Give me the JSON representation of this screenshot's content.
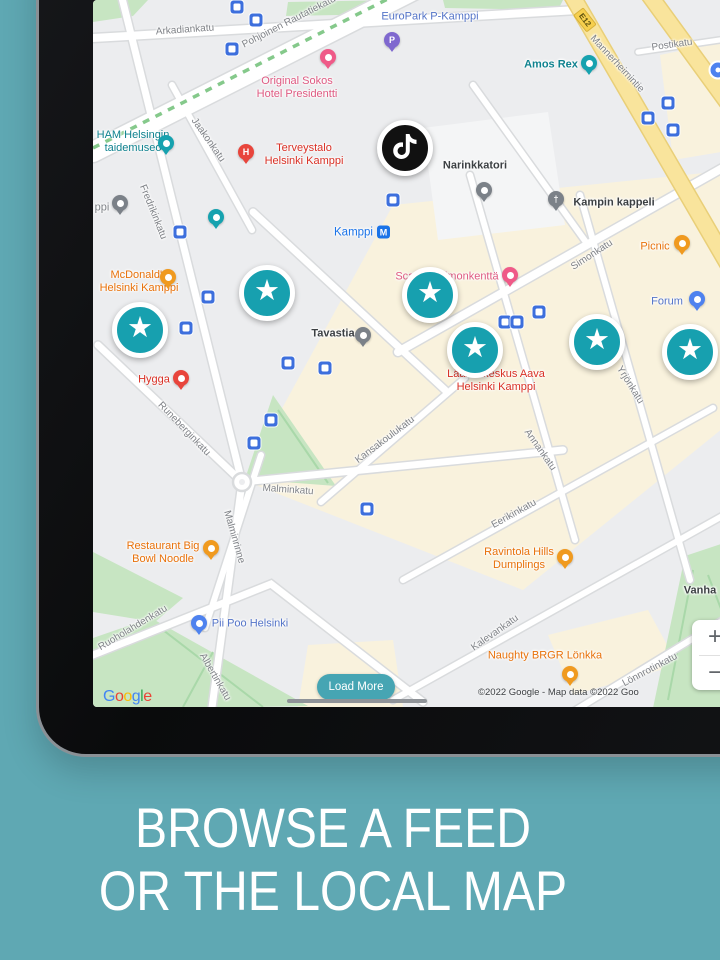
{
  "scene": {
    "background": "#5fa8b3"
  },
  "caption": {
    "line1": "BROWSE A FEED",
    "line2": "OR THE LOCAL MAP"
  },
  "colors": {
    "background_teal": "#5fa8b3",
    "star_teal": "#17a0af",
    "button_teal": "#46a5b3",
    "metro_blue": "#1a73e8",
    "road_yellow": "#f9e49c",
    "park_green": "#c7e5c2",
    "block_beige": "#f9f2dd",
    "hotel_pink": "#df5a82",
    "medical_red": "#d93025",
    "food_orange": "#e8710a",
    "poi_blue": "#5474c8",
    "attraction_teal": "#0f828f",
    "tiktok_black": "#111111"
  },
  "map": {
    "google_logo_letters": [
      "G",
      "o",
      "o",
      "g",
      "l",
      "e"
    ],
    "attribution": "©2022 Google - Map data ©2022 Goo",
    "load_more": "Load More",
    "zoom_in": "+",
    "zoom_out": "−",
    "star_glyph": "★",
    "metro": {
      "name": "Kamppi",
      "symbol": "M",
      "x": 269,
      "y": 232
    },
    "route_badge": {
      "text": "E12",
      "x": 492,
      "y": 20,
      "r": 52
    },
    "poi_dot": {
      "x": 625,
      "y": 70
    },
    "tiktok": {
      "x": 312,
      "y": 148
    },
    "street_labels": [
      {
        "t": "Arkadiankatu",
        "x": 92,
        "y": 30,
        "r": -4
      },
      {
        "t": "Pohjoinen Rautatiekatu",
        "x": 196,
        "y": 22,
        "r": -27
      },
      {
        "t": "Jaakonkatu",
        "x": 115,
        "y": 140,
        "r": 55
      },
      {
        "t": "Fredrikinkatu",
        "x": 60,
        "y": 212,
        "r": 68
      },
      {
        "t": "Mannerheimintie",
        "x": 524,
        "y": 64,
        "r": 47
      },
      {
        "t": "Postikatu",
        "x": 579,
        "y": 45,
        "r": -8
      },
      {
        "t": "Simonkatu",
        "x": 499,
        "y": 255,
        "r": -33
      },
      {
        "t": "Runeberginkatu",
        "x": 91,
        "y": 429,
        "r": 46
      },
      {
        "t": "Malminkatu",
        "x": 195,
        "y": 490,
        "r": 4
      },
      {
        "t": "Kansakoulukatu",
        "x": 292,
        "y": 440,
        "r": -37
      },
      {
        "t": "Annankatu",
        "x": 447,
        "y": 450,
        "r": 55
      },
      {
        "t": "Yrjönkatu",
        "x": 537,
        "y": 385,
        "r": 58
      },
      {
        "t": "Malminrinne",
        "x": 141,
        "y": 537,
        "r": 74
      },
      {
        "t": "Ruoholahdenkatu",
        "x": 40,
        "y": 628,
        "r": -31
      },
      {
        "t": "Albertinkatu",
        "x": 122,
        "y": 677,
        "r": 60
      },
      {
        "t": "Eerikinkatu",
        "x": 421,
        "y": 514,
        "r": -29
      },
      {
        "t": "Kalevankatu",
        "x": 402,
        "y": 633,
        "r": -35
      },
      {
        "t": "Lönnrotinkatu",
        "x": 557,
        "y": 670,
        "r": -28
      }
    ],
    "poi_labels": [
      {
        "lines": [
          "EuroPark P-Kamppi"
        ],
        "x": 337,
        "y": 17,
        "c": "blue"
      },
      {
        "lines": [
          "Original Sokos",
          "Hotel Presidentti"
        ],
        "x": 204,
        "y": 88,
        "c": "pink"
      },
      {
        "lines": [
          "Amos Rex"
        ],
        "x": 458,
        "y": 65,
        "c": "teal",
        "bold": true
      },
      {
        "lines": [
          "HAM Helsingin",
          "taidemuseo"
        ],
        "x": 40,
        "y": 142,
        "c": "teal"
      },
      {
        "lines": [
          "Terveystalo",
          "Helsinki Kamppi"
        ],
        "x": 211,
        "y": 155,
        "c": "red"
      },
      {
        "lines": [
          "Narinkkatori"
        ],
        "x": 382,
        "y": 166,
        "c": "dark"
      },
      {
        "lines": [
          "Kampin kappeli"
        ],
        "x": 521,
        "y": 203,
        "c": "dark"
      },
      {
        "lines": [
          "ppi"
        ],
        "x": 9,
        "y": 208,
        "c": "grey"
      },
      {
        "lines": [
          "Picnic"
        ],
        "x": 562,
        "y": 247,
        "c": "orange"
      },
      {
        "lines": [
          "Scandic Simonkenttä"
        ],
        "x": 354,
        "y": 277,
        "c": "pink"
      },
      {
        "lines": [
          "Forum"
        ],
        "x": 574,
        "y": 302,
        "c": "blue"
      },
      {
        "lines": [
          "McDonald's",
          "Helsinki Kamppi"
        ],
        "x": 46,
        "y": 282,
        "c": "orange"
      },
      {
        "lines": [
          "Tavastia"
        ],
        "x": 240,
        "y": 334,
        "c": "dark"
      },
      {
        "lines": [
          "Hygga"
        ],
        "x": 61,
        "y": 380,
        "c": "red"
      },
      {
        "lines": [
          "Lääkärikeskus Aava",
          "Helsinki Kamppi"
        ],
        "x": 403,
        "y": 381,
        "c": "red"
      },
      {
        "lines": [
          "Restaurant Big",
          "Bowl Noodle"
        ],
        "x": 70,
        "y": 553,
        "c": "orange"
      },
      {
        "lines": [
          "Ravintola Hills",
          "Dumplings"
        ],
        "x": 426,
        "y": 559,
        "c": "orange"
      },
      {
        "lines": [
          "Pii Poo Helsinki"
        ],
        "x": 157,
        "y": 624,
        "c": "blue"
      },
      {
        "lines": [
          "Naughty BRGR Lönkka"
        ],
        "x": 452,
        "y": 656,
        "c": "orange"
      },
      {
        "lines": [
          "Vanha"
        ],
        "x": 607,
        "y": 591,
        "c": "dark"
      }
    ],
    "markers": [
      {
        "type": "parking",
        "glyph": "P",
        "x": 299,
        "y": 40
      },
      {
        "type": "hotel",
        "x": 235,
        "y": 57
      },
      {
        "type": "attraction",
        "x": 496,
        "y": 63
      },
      {
        "type": "attraction",
        "x": 73,
        "y": 143
      },
      {
        "type": "hospital",
        "glyph": "H",
        "x": 153,
        "y": 152
      },
      {
        "type": "place",
        "x": 391,
        "y": 190
      },
      {
        "type": "place",
        "x": 27,
        "y": 203
      },
      {
        "type": "church",
        "glyph": "†",
        "x": 463,
        "y": 199
      },
      {
        "type": "attraction",
        "x": 123,
        "y": 217
      },
      {
        "type": "food",
        "x": 589,
        "y": 243
      },
      {
        "type": "shopping",
        "x": 604,
        "y": 299
      },
      {
        "type": "hotel",
        "x": 417,
        "y": 275
      },
      {
        "type": "food",
        "x": 75,
        "y": 277
      },
      {
        "type": "place",
        "x": 270,
        "y": 335
      },
      {
        "type": "medical",
        "x": 88,
        "y": 378
      },
      {
        "type": "food",
        "x": 118,
        "y": 548
      },
      {
        "type": "food",
        "x": 472,
        "y": 557
      },
      {
        "type": "shopping",
        "x": 106,
        "y": 623
      },
      {
        "type": "food",
        "x": 477,
        "y": 674
      }
    ],
    "stars": [
      {
        "x": 47,
        "y": 330
      },
      {
        "x": 174,
        "y": 293
      },
      {
        "x": 337,
        "y": 295
      },
      {
        "x": 382,
        "y": 350
      },
      {
        "x": 504,
        "y": 342
      },
      {
        "x": 597,
        "y": 352
      }
    ],
    "transit_icons": [
      {
        "x": 144,
        "y": 7
      },
      {
        "x": 163,
        "y": 20
      },
      {
        "x": 139,
        "y": 49
      },
      {
        "x": 300,
        "y": 200
      },
      {
        "x": 87,
        "y": 232
      },
      {
        "x": 115,
        "y": 297
      },
      {
        "x": 93,
        "y": 328
      },
      {
        "x": 446,
        "y": 312
      },
      {
        "x": 412,
        "y": 322
      },
      {
        "x": 424,
        "y": 322
      },
      {
        "x": 575,
        "y": 103
      },
      {
        "x": 555,
        "y": 118
      },
      {
        "x": 580,
        "y": 130
      },
      {
        "x": 195,
        "y": 363
      },
      {
        "x": 232,
        "y": 368
      },
      {
        "x": 178,
        "y": 420
      },
      {
        "x": 161,
        "y": 443
      },
      {
        "x": 274,
        "y": 509
      }
    ]
  }
}
